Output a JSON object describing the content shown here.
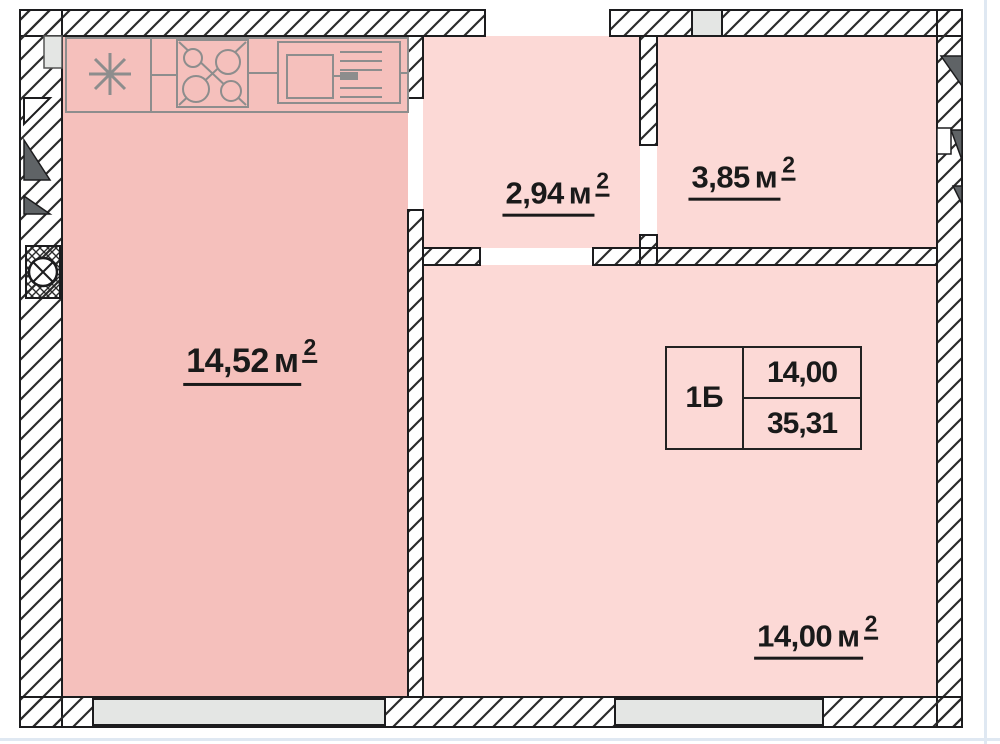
{
  "rooms": {
    "kitchen": {
      "area": "14,52",
      "unit": "м",
      "sup": "2"
    },
    "hallway": {
      "area": "2,94",
      "unit": "м",
      "sup": "2"
    },
    "bathroom": {
      "area": "3,85",
      "unit": "м",
      "sup": "2"
    },
    "living": {
      "area": "14,00",
      "unit": "м",
      "sup": "2"
    }
  },
  "unit_table": {
    "type": "1Б",
    "value_top": "14,00",
    "value_bottom": "35,31"
  },
  "colors": {
    "c-kitchen": "#f5c0bc",
    "c-room": "#fcd9d6",
    "c-window": "#e4e6e4",
    "c-wall": "#1c1c1e",
    "c-counter": "#8d8d8d",
    "c-vent": "#5f6366",
    "c-text": "#1a1a1a",
    "c-edge": "#dfe8f2"
  }
}
